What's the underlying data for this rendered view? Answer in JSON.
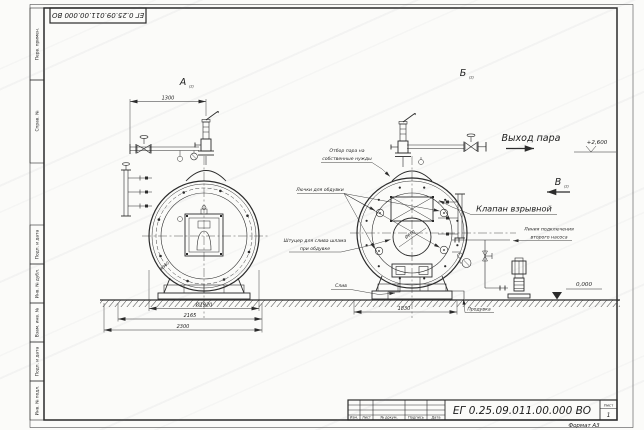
{
  "colors": {
    "line": "#2b2b2b",
    "paper": "#fbfbf9"
  },
  "stamp": {
    "designation": "ЕГ 0.25.09.011.00.000  ВО"
  },
  "side_column": {
    "top": [
      "Перв. примен.",
      "Справ. №"
    ],
    "bottom": [
      "Подп. и дата",
      "Инв. № дубл.",
      "Взам. инв. №",
      "Подп. и дата",
      "Инв. № подл."
    ]
  },
  "views": {
    "a": "А",
    "b": "Б",
    "v": "В",
    "sheet_ref": "(2)"
  },
  "labels": {
    "steam_outlet": "Выход пара",
    "own_needs_1": "Отбор пара на",
    "own_needs_2": "собственные нужды",
    "hatches": "Лючки для обдувки",
    "explosion_valve": "Клапан взрывной",
    "sludge_1": "Штуцер для слива шлама",
    "sludge_2": "при обдувке",
    "drain": "Слив",
    "blowdown": "Продувка",
    "second_pump_1": "Линия подключения",
    "second_pump_2": "второго насоса"
  },
  "dimensions": {
    "pipe_span": "1300",
    "shell_diameter": "Ø1920",
    "support_width": "2165",
    "overall_width": "2300",
    "rear_span": "1830",
    "center_bore": "Ø650",
    "shell_radius": "R960"
  },
  "elevations": {
    "steam_level": "+2,600",
    "floor_level": "0,000"
  },
  "title_block": {
    "designation": "ЕГ 0.25.09.011.00.000  ВО",
    "col_headers": [
      "Изм.",
      "Лист",
      "№ докум.",
      "Подпись",
      "Дата"
    ],
    "sheet_label": "Лист",
    "sheet_number": "1",
    "format": "Формат А3"
  }
}
